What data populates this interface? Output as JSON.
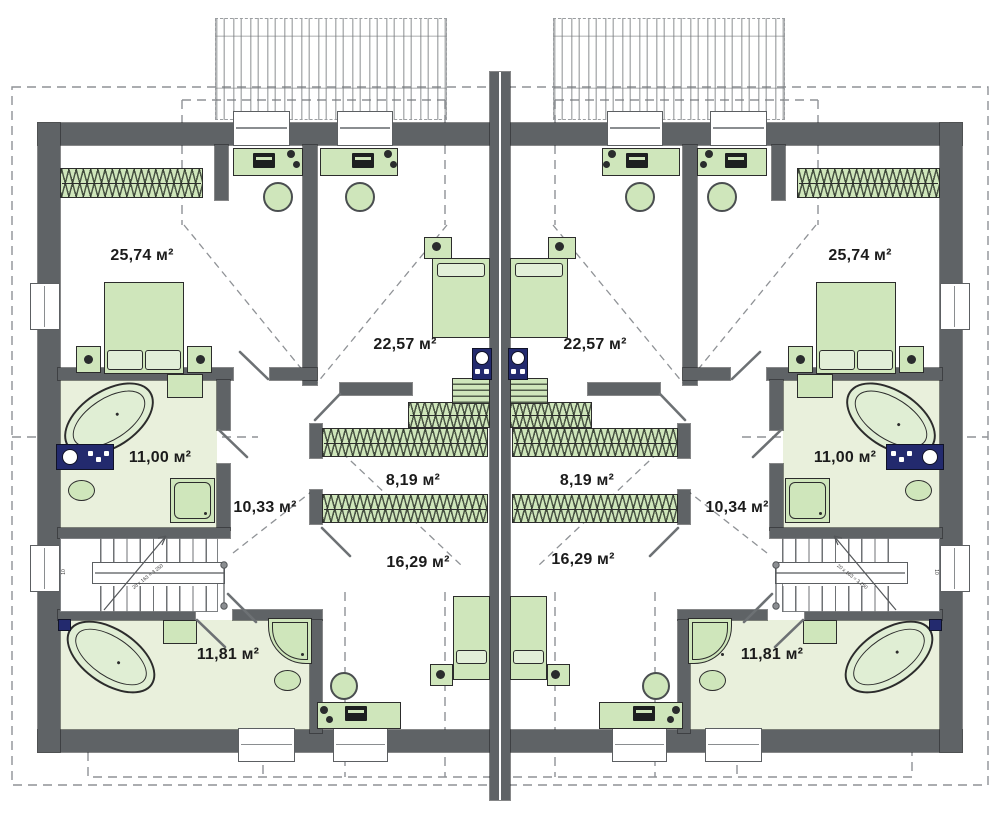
{
  "units_note": "м²",
  "left_unit": {
    "bedroom_top_area": "25,74 м²",
    "bedroom_mid_area": "22,57 м²",
    "bathroom_top_area": "11,00 м²",
    "hall_area": "10,33 м²",
    "closet_area": "8,19 м²",
    "bedroom_bottom_area": "16,29 м²",
    "bathroom_bottom_area": "11,81 м²",
    "stairs_count": "10",
    "stairs_note": "20 x 163 = 3 250"
  },
  "right_unit": {
    "bedroom_top_area": "25,74 м²",
    "bedroom_mid_area": "22,57 м²",
    "bathroom_top_area": "11,00 м²",
    "hall_area": "10,34 м²",
    "closet_area": "8,19 м²",
    "bedroom_bottom_area": "16,29 м²",
    "bathroom_bottom_area": "11,81 м²",
    "stairs_count": "10",
    "stairs_note": "20 x 163 = 3 250"
  },
  "colors": {
    "wall": "#5f6366",
    "furniture_green": "#cfe6bb",
    "floor_green": "#e9f0dc",
    "navy": "#232a6e",
    "dash": "#8f9296"
  }
}
